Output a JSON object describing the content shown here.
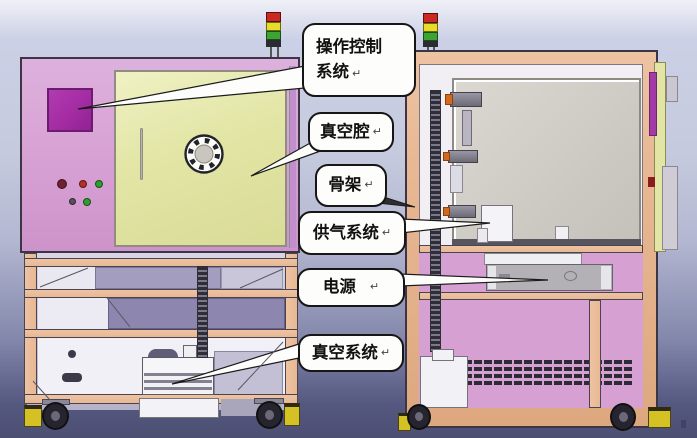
{
  "callouts": [
    {
      "id": "operation-control-system",
      "text": "操作控制系统",
      "lines": [
        "操作控制",
        "系统"
      ],
      "mark": "↵"
    },
    {
      "id": "vacuum-chamber",
      "text": "真空腔",
      "lines": [
        "真空腔"
      ],
      "mark": "↵"
    },
    {
      "id": "skeleton-frame",
      "text": "骨架",
      "lines": [
        "骨架"
      ],
      "mark": "↵"
    },
    {
      "id": "gas-supply-system",
      "text": "供气系统",
      "lines": [
        "供气系统"
      ],
      "mark": "↵"
    },
    {
      "id": "power-supply",
      "text": "电源",
      "lines": [
        "电源"
      ],
      "mark": "↵"
    },
    {
      "id": "vacuum-system",
      "text": "真空系统",
      "lines": [
        "真空系统"
      ],
      "mark": "↵"
    }
  ],
  "colors": {
    "panel_pink": "#d7a0d3",
    "door_yellow": "#e2e5a4",
    "screen_purple": "#a22ba2",
    "frame_tan": "#e8b894",
    "chamber_gray": "#cdcac4",
    "tower_red": "#c92a21",
    "tower_yellow": "#e6dd2b",
    "tower_green": "#3da332",
    "caster_yellow": "#d6c125",
    "bg_top": "#eff0f7",
    "bg_bottom": "#4c4f72",
    "callout_bg": "#fdfdfc",
    "callout_border": "#161616"
  }
}
